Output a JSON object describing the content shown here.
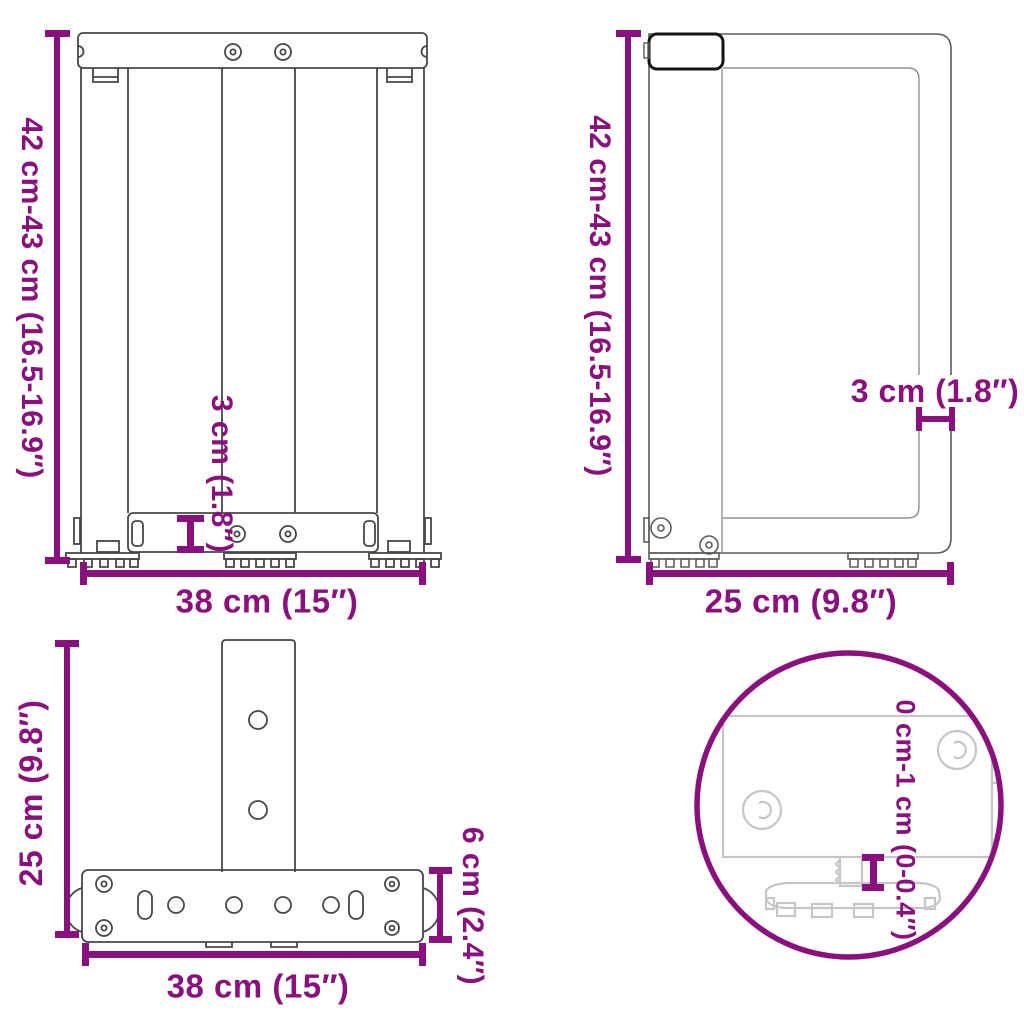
{
  "accent_color": "#8A107E",
  "views": {
    "front": {
      "height_label": "42 cm-43 cm (16.5-16.9″)",
      "width_label": "38 cm (15″)",
      "bar_thickness_label": "3 cm (1.8″)"
    },
    "side": {
      "height_label": "42 cm-43 cm (16.5-16.9″)",
      "width_label": "25 cm (9.8″)",
      "thickness_label": "3 cm (1.8″)"
    },
    "top": {
      "depth_label": "25 cm (9.8″)",
      "width_label": "38 cm (15″)",
      "bar_height_label": "6 cm (2.4″)"
    },
    "detail": {
      "adjust_range_label": "0 cm-1 cm (0-0.4″)"
    }
  }
}
